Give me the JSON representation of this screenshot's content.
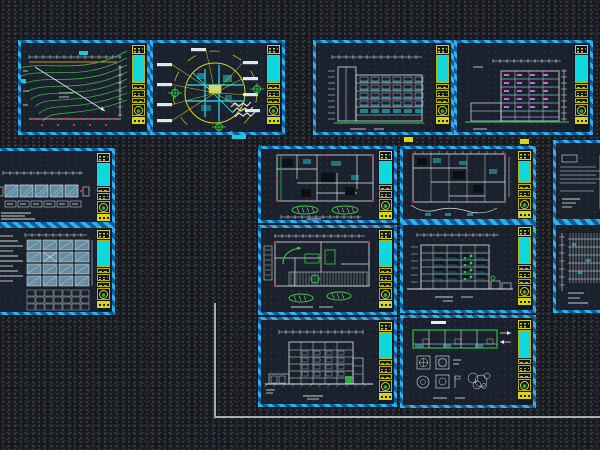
{
  "app": {
    "view_name": "cad-model-space",
    "canvas": {
      "width": 600,
      "height": 450
    }
  },
  "palette": {
    "background": "#161a23",
    "sheet_fill": "#1a202c",
    "border_cyan": "#2ab4e8",
    "border_blue": "#135a9e",
    "titleblock_yellow": "#d8d41c",
    "titleblock_cyan": "#0fd8dc",
    "line_white": "#dfe7ea",
    "line_green": "#2fae3f",
    "marker_green": "#38d13c",
    "line_cyan": "#20c8d8",
    "panel_blue": "#7fb3cf",
    "accent_red": "#cc3333",
    "accent_magenta": "#d864c8",
    "dim_yellow": "#c8941e",
    "leader_yellow": "#d8d41c",
    "boundary_gray": "#a9adb0"
  },
  "sheets": [
    {
      "id": "grading-plan",
      "kind": "contour",
      "x": 18,
      "y": 40,
      "w": 132,
      "h": 95,
      "strip": "right",
      "desc": "site grading plan with green contour lines and diagonal survey line"
    },
    {
      "id": "site-location-plan",
      "kind": "siteCircle",
      "x": 150,
      "y": 40,
      "w": 135,
      "h": 95,
      "strip": "right",
      "desc": "circular site location map, cyan street blocks, yellow leaders to white labels, green survey crosshairs"
    },
    {
      "id": "building-section-1",
      "kind": "sectionA",
      "x": 313,
      "y": 40,
      "w": 141,
      "h": 95,
      "strip": "right",
      "desc": "five storey building section with cyan window bands and green ground line"
    },
    {
      "id": "building-section-2",
      "kind": "sectionB",
      "x": 454,
      "y": 40,
      "w": 139,
      "h": 95,
      "strip": "right",
      "desc": "building section with magenta slab marks and right dimension column"
    },
    {
      "id": "long-elevation-strip",
      "kind": "stripPlan",
      "x": -8,
      "y": 148,
      "w": 123,
      "h": 77,
      "strip": "right",
      "desc": "long strip elevation with blue glazing panels, clipped at left edge"
    },
    {
      "id": "roof-framing-plan",
      "kind": "roofGrid",
      "x": -8,
      "y": 225,
      "w": 123,
      "h": 90,
      "strip": "right",
      "desc": "roof coffer grid plan with blue panels and note lines, clipped at left edge"
    },
    {
      "id": "floor-plan-upper",
      "kind": "floorPlan1",
      "x": 258,
      "y": 146,
      "w": 139,
      "h": 77,
      "strip": "right",
      "desc": "detailed floor plan with cyan rooms, red grid dots, two green ramp ellipses"
    },
    {
      "id": "floor-plan-ground",
      "kind": "floorPlan2",
      "x": 258,
      "y": 225,
      "w": 139,
      "h": 90,
      "strip": "right",
      "desc": "ground floor plan with green turning arrows, parking stall hatch, green ramp ellipses"
    },
    {
      "id": "street-elevation",
      "kind": "elevationFront",
      "x": 258,
      "y": 317,
      "w": 139,
      "h": 90,
      "strip": "right",
      "desc": "street elevation with floor grid, green entry block and annex boxes"
    },
    {
      "id": "floor-plan-typical",
      "kind": "floorPlan3",
      "x": 400,
      "y": 146,
      "w": 136,
      "h": 76,
      "strip": "right",
      "desc": "typical floor plan with wavy site boundary below"
    },
    {
      "id": "side-elevation",
      "kind": "elevationSide",
      "x": 400,
      "y": 222,
      "w": 136,
      "h": 91,
      "strip": "right",
      "desc": "side elevation with green planting dots and right out-buildings"
    },
    {
      "id": "wall-section-details",
      "kind": "sectionDetails",
      "x": 400,
      "y": 315,
      "w": 136,
      "h": 93,
      "strip": "right",
      "desc": "green-outlined long section strip plus detail callout symbols"
    },
    {
      "id": "stair-detail-fragment",
      "kind": "stairFrag",
      "x": 553,
      "y": 140,
      "w": 55,
      "h": 82,
      "strip": "none",
      "desc": "stair tread detail, clipped at right edge"
    },
    {
      "id": "wall-hatch-fragment",
      "kind": "hatchFrag",
      "x": 553,
      "y": 222,
      "w": 55,
      "h": 91,
      "strip": "none",
      "desc": "dense wall hatch detail, clipped at right edge"
    }
  ],
  "fragments": [
    {
      "x": 232,
      "y": 135,
      "w": 14,
      "h": 4,
      "color": "#19cdd6"
    },
    {
      "x": 404,
      "y": 137,
      "w": 9,
      "h": 5,
      "color": "#d8d41c"
    },
    {
      "x": 520,
      "y": 139,
      "w": 9,
      "h": 5,
      "color": "#d8d41c"
    }
  ],
  "boundary_polyline": {
    "points": [
      [
        215,
        303
      ],
      [
        215,
        417
      ],
      [
        600,
        417
      ]
    ],
    "color": "#a9adb0",
    "width": 2
  }
}
